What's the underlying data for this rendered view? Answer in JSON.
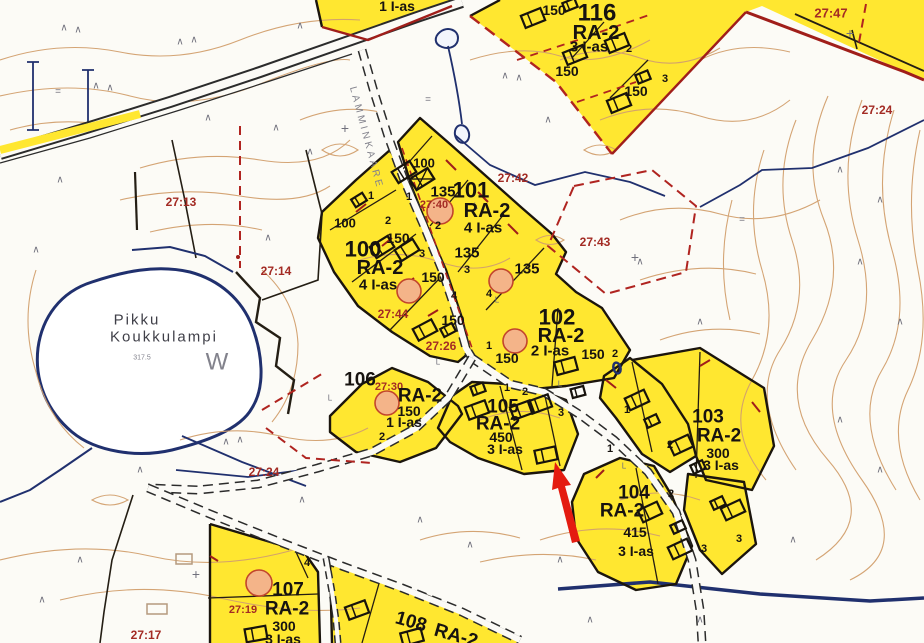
{
  "map": {
    "background": "#fcfbf6",
    "colors": {
      "parcel_fill": "#ffe730",
      "parcel_border": "#1b150d",
      "plan_red": "#b02420",
      "solid_red": "#a01e1a",
      "contour": "#d2a06e",
      "water_blue": "#20306e",
      "label_black": "#171310",
      "cadastral_red": "#a32b24",
      "gray_text": "#82828c",
      "dark_gray_text": "#3f3f48",
      "arrow_red": "#e41b10",
      "circle_fill": "#f4b489",
      "circle_stroke": "#c2452c",
      "road_fill": "#fbfaf6"
    },
    "lake": {
      "name_line1": "Pikku",
      "name_line2": "Koukkulampi",
      "letter": "W",
      "elevation": "317.5"
    },
    "road_name": "LAMMINKAARE",
    "texts": [
      {
        "name": "parcel-116-number",
        "t": "116",
        "x": 597,
        "y": 13,
        "s": 24
      },
      {
        "name": "parcel-116-zoning",
        "t": "RA-2",
        "x": 596,
        "y": 33,
        "s": 20
      },
      {
        "name": "parcel-116-dwellings",
        "t": "3 I-as",
        "x": 589,
        "y": 47,
        "s": 15
      },
      {
        "name": "area-label",
        "t": "150",
        "x": 554,
        "y": 10,
        "s": 14
      },
      {
        "name": "area-label",
        "t": "150",
        "x": 567,
        "y": 71,
        "s": 14
      },
      {
        "name": "area-label",
        "t": "150",
        "x": 636,
        "y": 91,
        "s": 14
      },
      {
        "name": "lot-number",
        "t": "2",
        "x": 629,
        "y": 49,
        "s": 11
      },
      {
        "name": "lot-number",
        "t": "3",
        "x": 665,
        "y": 79,
        "s": 11
      },
      {
        "name": "parcel-dwellings",
        "t": "1 I-as",
        "x": 397,
        "y": 6,
        "s": 14
      },
      {
        "name": "cadastral-ref",
        "t": "27:47",
        "x": 831,
        "y": 13,
        "s": 13,
        "c": "red"
      },
      {
        "name": "cadastral-ref",
        "t": "27:24",
        "x": 877,
        "y": 110,
        "s": 12,
        "c": "red"
      },
      {
        "name": "cadastral-ref",
        "t": "27:13",
        "x": 181,
        "y": 202,
        "s": 12,
        "c": "red"
      },
      {
        "name": "cadastral-ref",
        "t": "27:14",
        "x": 276,
        "y": 271,
        "s": 12,
        "c": "red"
      },
      {
        "name": "cadastral-ref",
        "t": "27:42",
        "x": 513,
        "y": 178,
        "s": 12,
        "c": "red"
      },
      {
        "name": "cadastral-ref",
        "t": "27:43",
        "x": 595,
        "y": 242,
        "s": 12,
        "c": "red"
      },
      {
        "name": "cadastral-ref",
        "t": "27:40",
        "x": 434,
        "y": 205,
        "s": 11,
        "c": "red"
      },
      {
        "name": "cadastral-ref",
        "t": "27:44",
        "x": 393,
        "y": 314,
        "s": 12,
        "c": "red"
      },
      {
        "name": "cadastral-ref",
        "t": "27:26",
        "x": 441,
        "y": 346,
        "s": 12,
        "c": "red"
      },
      {
        "name": "cadastral-ref",
        "t": "27:30",
        "x": 389,
        "y": 387,
        "s": 11,
        "c": "red"
      },
      {
        "name": "cadastral-ref",
        "t": "27:24",
        "x": 264,
        "y": 472,
        "s": 12,
        "c": "red"
      },
      {
        "name": "cadastral-ref",
        "t": "27:19",
        "x": 243,
        "y": 610,
        "s": 11,
        "c": "red"
      },
      {
        "name": "cadastral-ref",
        "t": "27:17",
        "x": 146,
        "y": 635,
        "s": 12,
        "c": "red"
      },
      {
        "name": "parcel-101-number",
        "t": "101",
        "x": 471,
        "y": 190,
        "s": 22
      },
      {
        "name": "parcel-101-zoning",
        "t": "RA-2",
        "x": 487,
        "y": 211,
        "s": 20
      },
      {
        "name": "parcel-101-dwellings",
        "t": "4 I-as",
        "x": 483,
        "y": 228,
        "s": 15
      },
      {
        "name": "area-label",
        "t": "135",
        "x": 443,
        "y": 192,
        "s": 15
      },
      {
        "name": "area-label",
        "t": "135",
        "x": 467,
        "y": 253,
        "s": 15
      },
      {
        "name": "area-label",
        "t": "135",
        "x": 527,
        "y": 269,
        "s": 15
      },
      {
        "name": "area-label",
        "t": "100",
        "x": 424,
        "y": 163,
        "s": 13
      },
      {
        "name": "area-label",
        "t": "150",
        "x": 398,
        "y": 238,
        "s": 14
      },
      {
        "name": "area-label",
        "t": "150",
        "x": 433,
        "y": 277,
        "s": 14
      },
      {
        "name": "area-label",
        "t": "150",
        "x": 453,
        "y": 320,
        "s": 14
      },
      {
        "name": "parcel-100-number",
        "t": "100",
        "x": 345,
        "y": 223,
        "s": 13
      },
      {
        "name": "parcel-100-number",
        "t": "100",
        "x": 363,
        "y": 249,
        "s": 22
      },
      {
        "name": "parcel-100-zoning",
        "t": "RA-2",
        "x": 380,
        "y": 268,
        "s": 20
      },
      {
        "name": "parcel-100-dwellings",
        "t": "4 I-as",
        "x": 378,
        "y": 285,
        "s": 15
      },
      {
        "name": "lot-number",
        "t": "1",
        "x": 371,
        "y": 196,
        "s": 11
      },
      {
        "name": "lot-number",
        "t": "1",
        "x": 409,
        "y": 197,
        "s": 11
      },
      {
        "name": "lot-number",
        "t": "2",
        "x": 388,
        "y": 221,
        "s": 11
      },
      {
        "name": "lot-number",
        "t": "2",
        "x": 438,
        "y": 226,
        "s": 11
      },
      {
        "name": "lot-number",
        "t": "3",
        "x": 422,
        "y": 254,
        "s": 11
      },
      {
        "name": "lot-number",
        "t": "3",
        "x": 467,
        "y": 270,
        "s": 11
      },
      {
        "name": "lot-number",
        "t": "4",
        "x": 454,
        "y": 296,
        "s": 11
      },
      {
        "name": "lot-number",
        "t": "4",
        "x": 489,
        "y": 294,
        "s": 11
      },
      {
        "name": "parcel-102-number",
        "t": "102",
        "x": 557,
        "y": 317,
        "s": 22
      },
      {
        "name": "parcel-102-zoning",
        "t": "RA-2",
        "x": 561,
        "y": 336,
        "s": 20
      },
      {
        "name": "parcel-102-dwellings",
        "t": "2 I-as",
        "x": 550,
        "y": 351,
        "s": 15
      },
      {
        "name": "area-label",
        "t": "150",
        "x": 507,
        "y": 358,
        "s": 14
      },
      {
        "name": "area-label",
        "t": "150",
        "x": 593,
        "y": 354,
        "s": 14
      },
      {
        "name": "lot-number",
        "t": "1",
        "x": 489,
        "y": 346,
        "s": 11
      },
      {
        "name": "lot-number",
        "t": "2",
        "x": 615,
        "y": 354,
        "s": 11
      },
      {
        "name": "parcel-106-number",
        "t": "106",
        "x": 360,
        "y": 380,
        "s": 19
      },
      {
        "name": "parcel-106-zoning",
        "t": "RA-2",
        "x": 420,
        "y": 396,
        "s": 19
      },
      {
        "name": "area-label",
        "t": "150",
        "x": 409,
        "y": 411,
        "s": 14
      },
      {
        "name": "parcel-106-dwellings",
        "t": "1 I-as",
        "x": 404,
        "y": 422,
        "s": 14
      },
      {
        "name": "lot-number",
        "t": "2",
        "x": 382,
        "y": 437,
        "s": 11
      },
      {
        "name": "parcel-105-number",
        "t": "105",
        "x": 503,
        "y": 407,
        "s": 19
      },
      {
        "name": "parcel-105-zoning",
        "t": "RA-2",
        "x": 498,
        "y": 424,
        "s": 19
      },
      {
        "name": "area-label",
        "t": "450",
        "x": 501,
        "y": 437,
        "s": 14
      },
      {
        "name": "parcel-105-dwellings",
        "t": "3 I-as",
        "x": 505,
        "y": 449,
        "s": 14
      },
      {
        "name": "lot-number",
        "t": "1",
        "x": 507,
        "y": 388,
        "s": 11
      },
      {
        "name": "lot-number",
        "t": "2",
        "x": 525,
        "y": 392,
        "s": 11
      },
      {
        "name": "lot-number",
        "t": "3",
        "x": 561,
        "y": 413,
        "s": 11
      },
      {
        "name": "parcel-103-number",
        "t": "103",
        "x": 708,
        "y": 417,
        "s": 19
      },
      {
        "name": "parcel-103-zoning",
        "t": "RA-2",
        "x": 719,
        "y": 436,
        "s": 19
      },
      {
        "name": "area-label",
        "t": "300",
        "x": 718,
        "y": 453,
        "s": 14
      },
      {
        "name": "parcel-103-dwellings",
        "t": "3 I-as",
        "x": 721,
        "y": 465,
        "s": 14
      },
      {
        "name": "lot-number",
        "t": "1",
        "x": 627,
        "y": 410,
        "s": 11
      },
      {
        "name": "lot-number",
        "t": "2",
        "x": 670,
        "y": 445,
        "s": 11
      },
      {
        "name": "lot-number",
        "t": "1",
        "x": 610,
        "y": 449,
        "s": 11
      },
      {
        "name": "lot-number",
        "t": "2",
        "x": 671,
        "y": 494,
        "s": 11
      },
      {
        "name": "parcel-104-number",
        "t": "104",
        "x": 634,
        "y": 493,
        "s": 19
      },
      {
        "name": "parcel-104-zoning",
        "t": "RA-2",
        "x": 622,
        "y": 511,
        "s": 19
      },
      {
        "name": "area-label",
        "t": "415",
        "x": 635,
        "y": 532,
        "s": 14
      },
      {
        "name": "parcel-104-dwellings",
        "t": "3 I-as",
        "x": 636,
        "y": 551,
        "s": 14
      },
      {
        "name": "lot-number",
        "t": "3",
        "x": 704,
        "y": 549,
        "s": 11
      },
      {
        "name": "lot-number",
        "t": "3",
        "x": 739,
        "y": 539,
        "s": 11
      },
      {
        "name": "parcel-107-number",
        "t": "107",
        "x": 288,
        "y": 590,
        "s": 19
      },
      {
        "name": "parcel-107-zoning",
        "t": "RA-2",
        "x": 287,
        "y": 609,
        "s": 19
      },
      {
        "name": "area-label",
        "t": "300",
        "x": 284,
        "y": 626,
        "s": 14
      },
      {
        "name": "parcel-107-dwellings",
        "t": "3 I-as",
        "x": 283,
        "y": 639,
        "s": 14
      },
      {
        "name": "lot-number",
        "t": "4",
        "x": 307,
        "y": 563,
        "s": 11
      },
      {
        "name": "parcel-108-number",
        "t": "108",
        "x": 411,
        "y": 622,
        "s": 19,
        "r": 16
      },
      {
        "name": "parcel-108-zoning",
        "t": "RA-2",
        "x": 456,
        "y": 636,
        "s": 19,
        "r": 16
      },
      {
        "name": "lake-name-line1",
        "t": "Pikku",
        "x": 137,
        "y": 320,
        "s": 15,
        "c": "gray2",
        "w": 400,
        "ls": 2
      },
      {
        "name": "lake-name-line2",
        "t": "Koukkulampi",
        "x": 164,
        "y": 337,
        "s": 15,
        "c": "gray2",
        "w": 400,
        "ls": 2
      },
      {
        "name": "lake-letter",
        "t": "W",
        "x": 217,
        "y": 362,
        "s": 24,
        "c": "gray",
        "w": 400
      },
      {
        "name": "lake-elevation",
        "t": "317.5",
        "x": 142,
        "y": 358,
        "s": 7,
        "c": "gray",
        "w": 400
      },
      {
        "name": "road-name",
        "t": "LAMMINKAARE",
        "x": 366,
        "y": 138,
        "s": 10,
        "c": "gray",
        "w": 400,
        "r": 75,
        "ls": 3
      }
    ],
    "symbols": {
      "tree": "∧",
      "cross": "+",
      "marsh": "=",
      "spot": "L"
    },
    "symbol_instances": [
      {
        "g": "tree",
        "x": 64,
        "y": 28
      },
      {
        "g": "tree",
        "x": 78,
        "y": 30
      },
      {
        "g": "tree",
        "x": 180,
        "y": 42
      },
      {
        "g": "tree",
        "x": 194,
        "y": 40
      },
      {
        "g": "tree",
        "x": 300,
        "y": 26
      },
      {
        "g": "tree",
        "x": 96,
        "y": 86
      },
      {
        "g": "tree",
        "x": 110,
        "y": 88
      },
      {
        "g": "tree",
        "x": 208,
        "y": 118
      },
      {
        "g": "tree",
        "x": 310,
        "y": 152
      },
      {
        "g": "tree",
        "x": 60,
        "y": 180
      },
      {
        "g": "tree",
        "x": 36,
        "y": 250
      },
      {
        "g": "tree",
        "x": 276,
        "y": 128
      },
      {
        "g": "tree",
        "x": 505,
        "y": 76
      },
      {
        "g": "tree",
        "x": 519,
        "y": 78
      },
      {
        "g": "tree",
        "x": 548,
        "y": 120
      },
      {
        "g": "tree",
        "x": 268,
        "y": 238
      },
      {
        "g": "tree",
        "x": 640,
        "y": 262
      },
      {
        "g": "tree",
        "x": 700,
        "y": 322
      },
      {
        "g": "tree",
        "x": 840,
        "y": 170
      },
      {
        "g": "tree",
        "x": 880,
        "y": 200
      },
      {
        "g": "tree",
        "x": 860,
        "y": 262
      },
      {
        "g": "tree",
        "x": 900,
        "y": 322
      },
      {
        "g": "tree",
        "x": 840,
        "y": 420
      },
      {
        "g": "tree",
        "x": 880,
        "y": 470
      },
      {
        "g": "tree",
        "x": 793,
        "y": 540
      },
      {
        "g": "tree",
        "x": 700,
        "y": 620
      },
      {
        "g": "tree",
        "x": 560,
        "y": 560
      },
      {
        "g": "tree",
        "x": 302,
        "y": 500
      },
      {
        "g": "tree",
        "x": 80,
        "y": 560
      },
      {
        "g": "tree",
        "x": 42,
        "y": 600
      },
      {
        "g": "tree",
        "x": 140,
        "y": 470
      },
      {
        "g": "tree",
        "x": 420,
        "y": 520
      },
      {
        "g": "tree",
        "x": 470,
        "y": 545
      },
      {
        "g": "tree",
        "x": 590,
        "y": 620
      },
      {
        "g": "tree",
        "x": 240,
        "y": 440
      },
      {
        "g": "tree",
        "x": 226,
        "y": 442
      },
      {
        "g": "cross",
        "x": 635,
        "y": 257
      },
      {
        "g": "cross",
        "x": 850,
        "y": 33
      },
      {
        "g": "cross",
        "x": 196,
        "y": 574
      },
      {
        "g": "cross",
        "x": 345,
        "y": 128
      },
      {
        "g": "marsh",
        "x": 58,
        "y": 92
      },
      {
        "g": "marsh",
        "x": 428,
        "y": 100
      },
      {
        "g": "marsh",
        "x": 742,
        "y": 220
      },
      {
        "g": "spot",
        "x": 476,
        "y": 206
      },
      {
        "g": "spot",
        "x": 497,
        "y": 300
      },
      {
        "g": "spot",
        "x": 438,
        "y": 362
      },
      {
        "g": "spot",
        "x": 560,
        "y": 384
      },
      {
        "g": "spot",
        "x": 624,
        "y": 466
      },
      {
        "g": "spot",
        "x": 330,
        "y": 398
      }
    ],
    "buildings": [
      {
        "x": 533,
        "y": 18,
        "r": -22
      },
      {
        "x": 570,
        "y": 5,
        "r": -22,
        "small": true
      },
      {
        "x": 575,
        "y": 55,
        "r": -22
      },
      {
        "x": 617,
        "y": 43,
        "r": -22
      },
      {
        "x": 643,
        "y": 77,
        "r": -22,
        "small": true
      },
      {
        "x": 619,
        "y": 103,
        "r": -22
      },
      {
        "x": 382,
        "y": 247,
        "r": -32
      },
      {
        "x": 407,
        "y": 250,
        "r": -32
      },
      {
        "x": 404,
        "y": 172,
        "r": -32
      },
      {
        "x": 422,
        "y": 179,
        "r": -32,
        "hatched": true
      },
      {
        "x": 359,
        "y": 200,
        "r": -32,
        "small": true
      },
      {
        "x": 425,
        "y": 330,
        "r": -28
      },
      {
        "x": 448,
        "y": 330,
        "r": -28,
        "small": true
      },
      {
        "x": 566,
        "y": 366,
        "r": -15
      },
      {
        "x": 578,
        "y": 392,
        "r": -15,
        "small": true
      },
      {
        "x": 477,
        "y": 410,
        "r": -20
      },
      {
        "x": 522,
        "y": 410,
        "r": -20
      },
      {
        "x": 540,
        "y": 404,
        "r": -20
      },
      {
        "x": 546,
        "y": 455,
        "r": -12
      },
      {
        "x": 478,
        "y": 389,
        "r": -20,
        "small": true
      },
      {
        "x": 637,
        "y": 400,
        "r": -25
      },
      {
        "x": 652,
        "y": 421,
        "r": -25,
        "small": true
      },
      {
        "x": 681,
        "y": 445,
        "r": -25
      },
      {
        "x": 698,
        "y": 467,
        "r": -25,
        "small": true
      },
      {
        "x": 650,
        "y": 512,
        "r": -25
      },
      {
        "x": 678,
        "y": 527,
        "r": -25,
        "small": true
      },
      {
        "x": 680,
        "y": 549,
        "r": -25
      },
      {
        "x": 718,
        "y": 503,
        "r": -25,
        "small": true
      },
      {
        "x": 733,
        "y": 510,
        "r": -25
      },
      {
        "x": 256,
        "y": 634,
        "r": -10
      },
      {
        "x": 357,
        "y": 610,
        "r": -20
      },
      {
        "x": 412,
        "y": 637,
        "r": -15
      }
    ],
    "old_buildings": [
      {
        "x": 184,
        "y": 559,
        "w": 16,
        "h": 10
      },
      {
        "x": 157,
        "y": 609,
        "w": 20,
        "h": 10
      }
    ],
    "building_circles": [
      {
        "x": 440,
        "y": 211,
        "r": 13
      },
      {
        "x": 409,
        "y": 291,
        "r": 12
      },
      {
        "x": 501,
        "y": 281,
        "r": 12
      },
      {
        "x": 515,
        "y": 341,
        "r": 12
      },
      {
        "x": 387,
        "y": 403,
        "r": 12
      },
      {
        "x": 259,
        "y": 583,
        "r": 13
      }
    ],
    "spring": {
      "x": 617,
      "y": 368
    }
  }
}
